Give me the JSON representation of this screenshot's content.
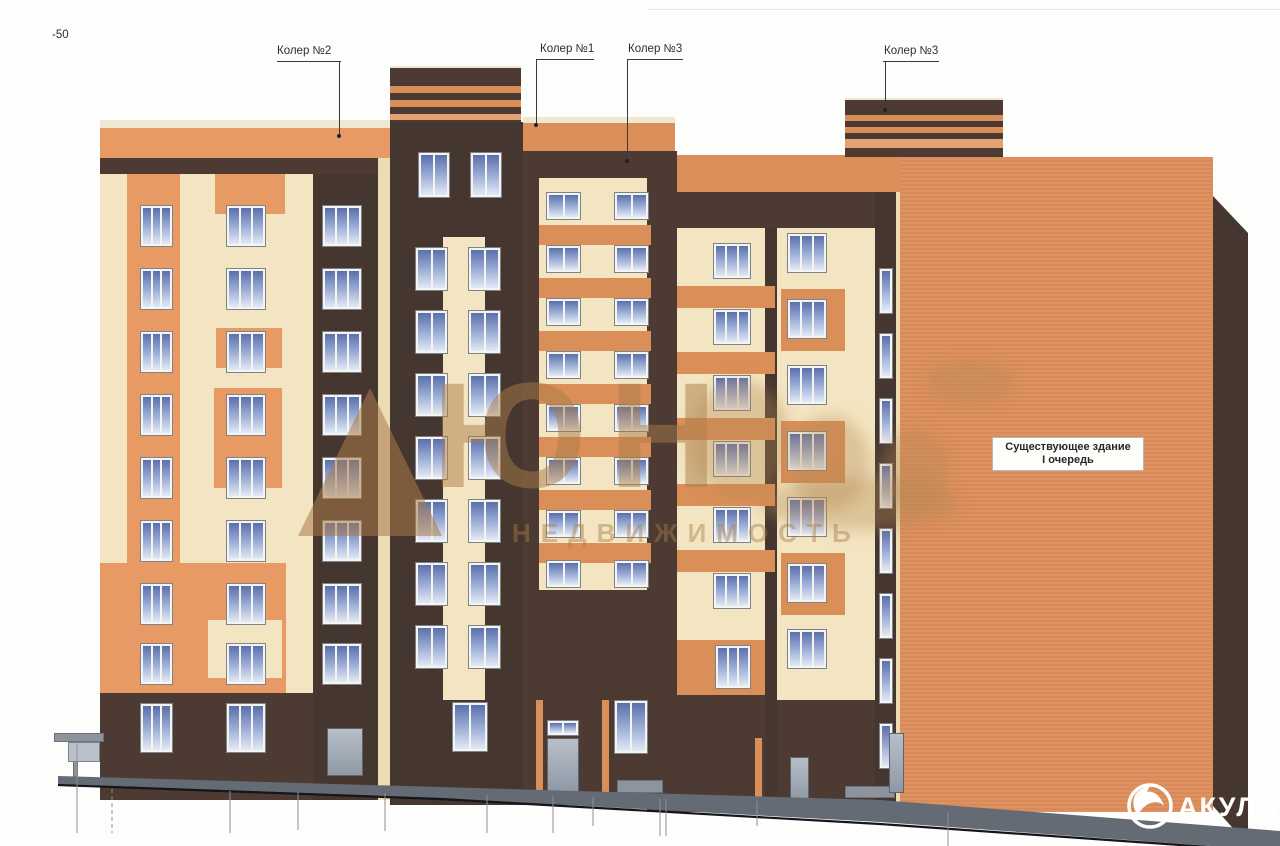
{
  "annotations": {
    "elevation_mark": "-50",
    "paint_labels": [
      {
        "text": "Колер №2"
      },
      {
        "text": "Колер №1"
      },
      {
        "text": "Колер №3"
      },
      {
        "text": "Колер №3"
      }
    ],
    "existing_building": {
      "line1": "Существующее здание",
      "line2": "I очередь"
    }
  },
  "watermarks": {
    "logo_text": "ЮН",
    "logo_subtitle": "НЕДВИЖИМОСТЬ",
    "corner_brand": "АКУЛА"
  },
  "palette": {
    "koler1_orange": "#db8f58",
    "koler2_peach": "#e79a63",
    "koler3_brown": "#4d3b33",
    "facade_cream": "#f3e5c1",
    "existing_brick": "#dc8d5a",
    "glass_blue": "#5a70ac",
    "plinth_gray": "#646b74",
    "watermark_sand": "#b5874f"
  }
}
